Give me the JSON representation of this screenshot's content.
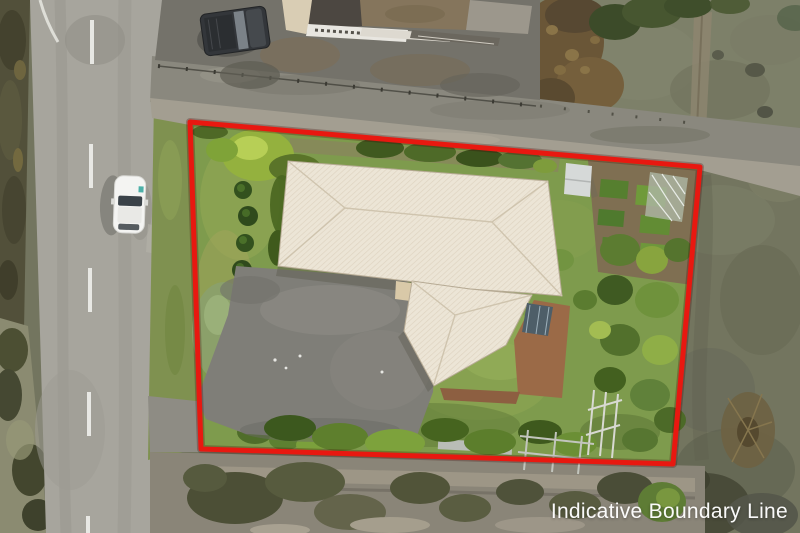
{
  "overlay": {
    "label": "Indicative Boundary Line",
    "label_color": "#ffffff",
    "boundary_color": "#e81810",
    "boundary_points": "190,122 700,167 673,464 201,449"
  }
}
